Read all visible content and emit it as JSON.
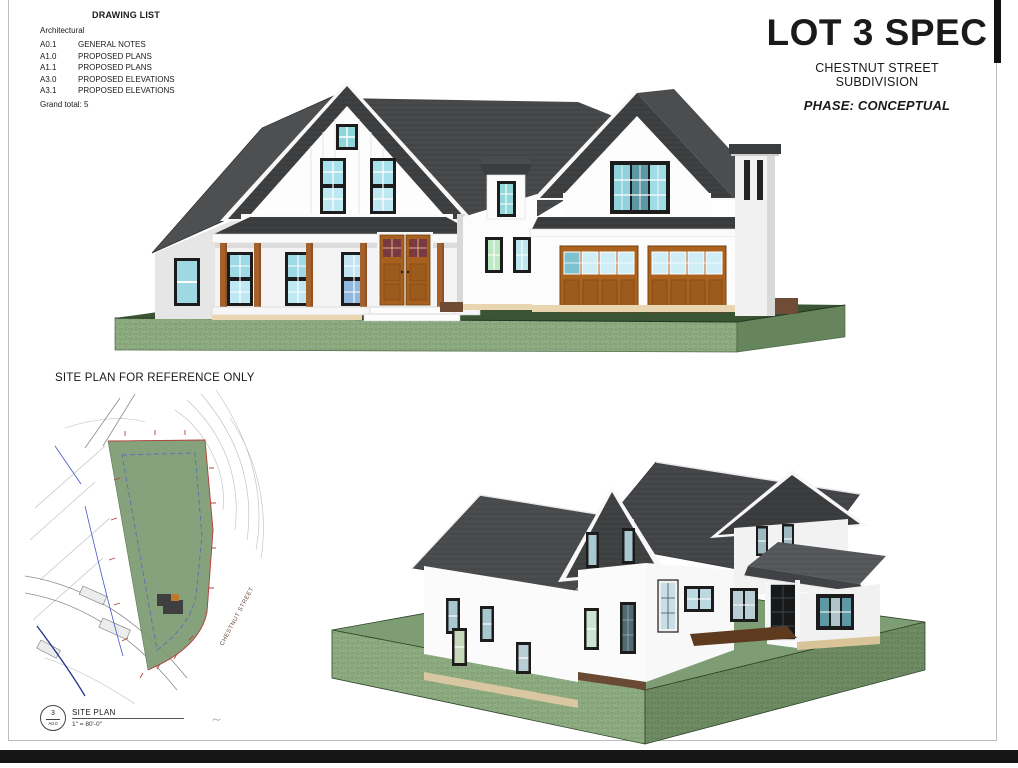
{
  "sheet": {
    "background": "#ffffff",
    "border_color": "#bdbdbd",
    "bottom_bar_color": "#161616"
  },
  "drawing_list": {
    "title": "DRAWING LIST",
    "category": "Architectural",
    "items": [
      {
        "number": "A0.1",
        "name": "GENERAL NOTES"
      },
      {
        "number": "A1.0",
        "name": "PROPOSED PLANS"
      },
      {
        "number": "A1.1",
        "name": "PROPOSED PLANS"
      },
      {
        "number": "A3.0",
        "name": "PROPOSED ELEVATIONS"
      },
      {
        "number": "A3.1",
        "name": "PROPOSED ELEVATIONS"
      }
    ],
    "grand_total": "Grand total: 5"
  },
  "title_block": {
    "project_title": "LOT 3 SPEC",
    "subdivision_line1": "CHESTNUT STREET",
    "subdivision_line2": "SUBDIVISION",
    "phase": "PHASE: CONCEPTUAL"
  },
  "site_plan": {
    "heading": "SITE PLAN FOR REFERENCE ONLY",
    "callout": {
      "detail_number": "3",
      "sheet_number": "A0.0"
    },
    "drawing_title": "SITE PLAN",
    "scale": "1\" = 80'-0\"",
    "street_label": "CHESTNUT STREET"
  },
  "palette": {
    "roof_dark": "#424445",
    "siding_white": "#fdfdfd",
    "window_glass_teal": "#a8dfe9",
    "front_door_wood": "#a7601e",
    "door_glass_red": "#7b3a3f",
    "garage_door_wood": "#ab621f",
    "grass_face_light": "#8fac82",
    "grass_top_dark": "#3a5434",
    "site_lot_green": "#7d9b72",
    "boundary_red": "#b5413c",
    "setback_blue": "#5a6fb0",
    "foundation_tan": "#e9d6b1"
  }
}
